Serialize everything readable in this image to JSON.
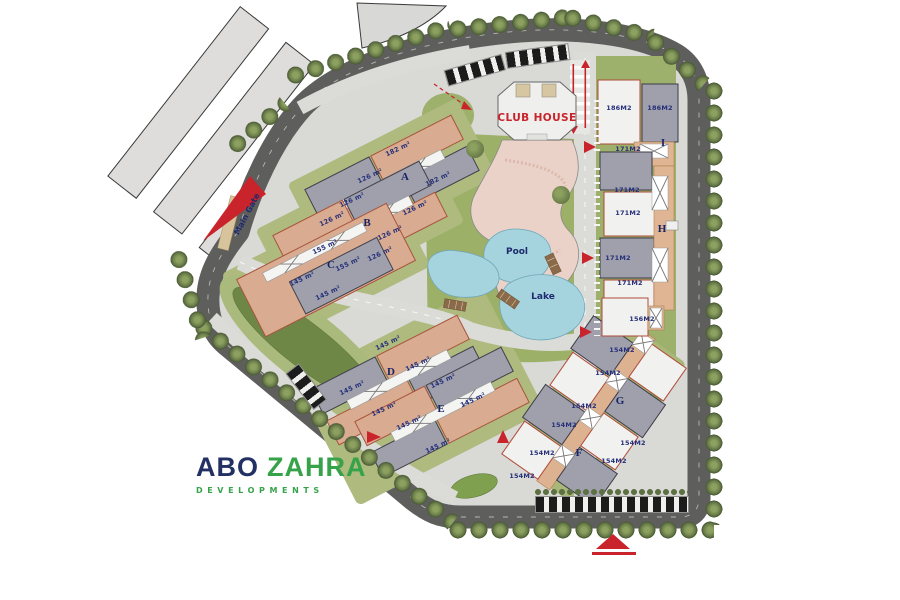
{
  "brand": {
    "abo": "ABO",
    "zahra": "ZAHRA",
    "tagline": "DEVELOPMENTS"
  },
  "places": {
    "club_house": "CLUB HOUSE",
    "pool": "Pool",
    "lake": "Lake",
    "main_gate": "Main Gate"
  },
  "buildings": [
    {
      "letter": "A",
      "units": [
        "182 m²",
        "126 m²",
        "182 m²",
        "126 m²"
      ]
    },
    {
      "letter": "B",
      "units": [
        "126 m²",
        "126 m²",
        "126 m²",
        "126 m²"
      ]
    },
    {
      "letter": "C",
      "units": [
        "155 m²",
        "155 m²",
        "145 m²",
        "145 m²"
      ]
    },
    {
      "letter": "D",
      "units": [
        "145 m²",
        "145 m²",
        "145 m²",
        "145 m²"
      ]
    },
    {
      "letter": "E",
      "units": [
        "145 m²",
        "145 m²",
        "145 m²",
        "145 m²"
      ]
    },
    {
      "letter": "F",
      "units": [
        "154M2",
        "154M2",
        "154M2",
        "154M2"
      ]
    },
    {
      "letter": "G",
      "units": [
        "154M2",
        "154M2",
        "154M2",
        "154M2"
      ]
    },
    {
      "letter": "H",
      "units": [
        "171M2",
        "171M2",
        "171M2",
        "171M2"
      ]
    },
    {
      "letter": "I",
      "units": [
        "186M2",
        "186M2",
        "171M2"
      ]
    },
    {
      "letter": "",
      "units": [
        "156M2"
      ]
    }
  ],
  "colors": {
    "navy": "#26307a",
    "green": "#36a34a",
    "red": "#c9232b",
    "road": "#5e5e5c",
    "water": "#a5d3de",
    "deck": "#ead2c8",
    "tan_building": "#d9ab90",
    "gray_building": "#9fa0ac",
    "grass": "#9db06c"
  }
}
